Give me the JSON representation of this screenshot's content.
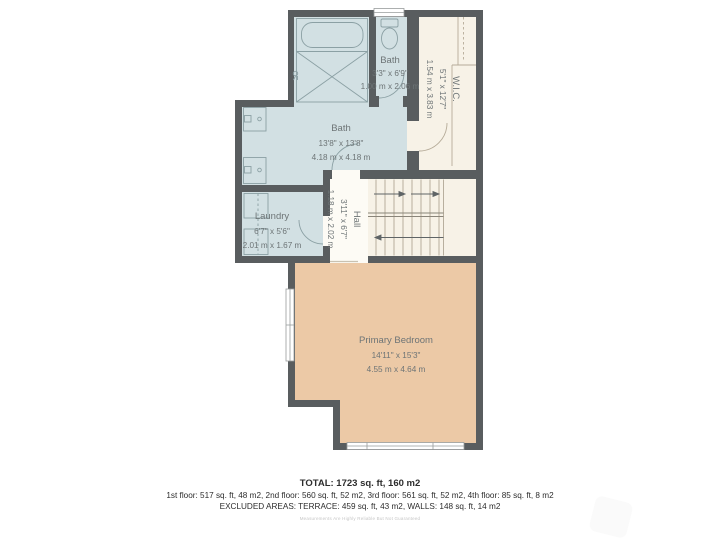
{
  "plan": {
    "rooms": {
      "bath_main": {
        "name": "Bath",
        "imperial": "13'8\" x 13'8\"",
        "metric": "4.18 m x 4.18 m"
      },
      "bath_small": {
        "name": "Bath",
        "imperial": "3'3\" x 6'9\"",
        "metric": "1.00 m x 2.06 m"
      },
      "wic": {
        "name": "W.I.C.",
        "imperial": "5'1\" x 12'7\"",
        "metric": "1.54 m x 3.83 m"
      },
      "laundry": {
        "name": "Laundry",
        "imperial": "6'7\" x 5'6\"",
        "metric": "2.01 m x 1.67 m"
      },
      "hall": {
        "name": "Hall",
        "imperial": "3'11\" x 6'7\"",
        "metric": "1.18 m x 2.02 m"
      },
      "primary_bedroom": {
        "name": "Primary Bedroom",
        "imperial": "14'11\" x 15'3\"",
        "metric": "4.55 m x 4.64 m"
      }
    },
    "colors": {
      "wall": "#595d5f",
      "wet_room_fill": "#d2e0e3",
      "closet_fill": "#f7f2e7",
      "hall_fill": "#fdfbf5",
      "bedroom_fill": "#ecc9a6",
      "fixture_line": "#8ba0a4",
      "closet_line": "#b5ab98",
      "label_text": "#6d7476"
    }
  },
  "summary": {
    "total": "TOTAL: 1723 sq. ft, 160 m2",
    "floors": "1st floor: 517 sq. ft, 48 m2, 2nd floor: 560 sq. ft, 52 m2, 3rd floor: 561 sq. ft, 52 m2, 4th floor: 85 sq. ft, 8 m2",
    "excluded": "EXCLUDED AREAS: TERRACE: 459 sq. ft, 43 m2, WALLS: 148 sq. ft, 14 m2",
    "disclaimer": "Measurements Are Highly Reliable But Not Guaranteed"
  }
}
